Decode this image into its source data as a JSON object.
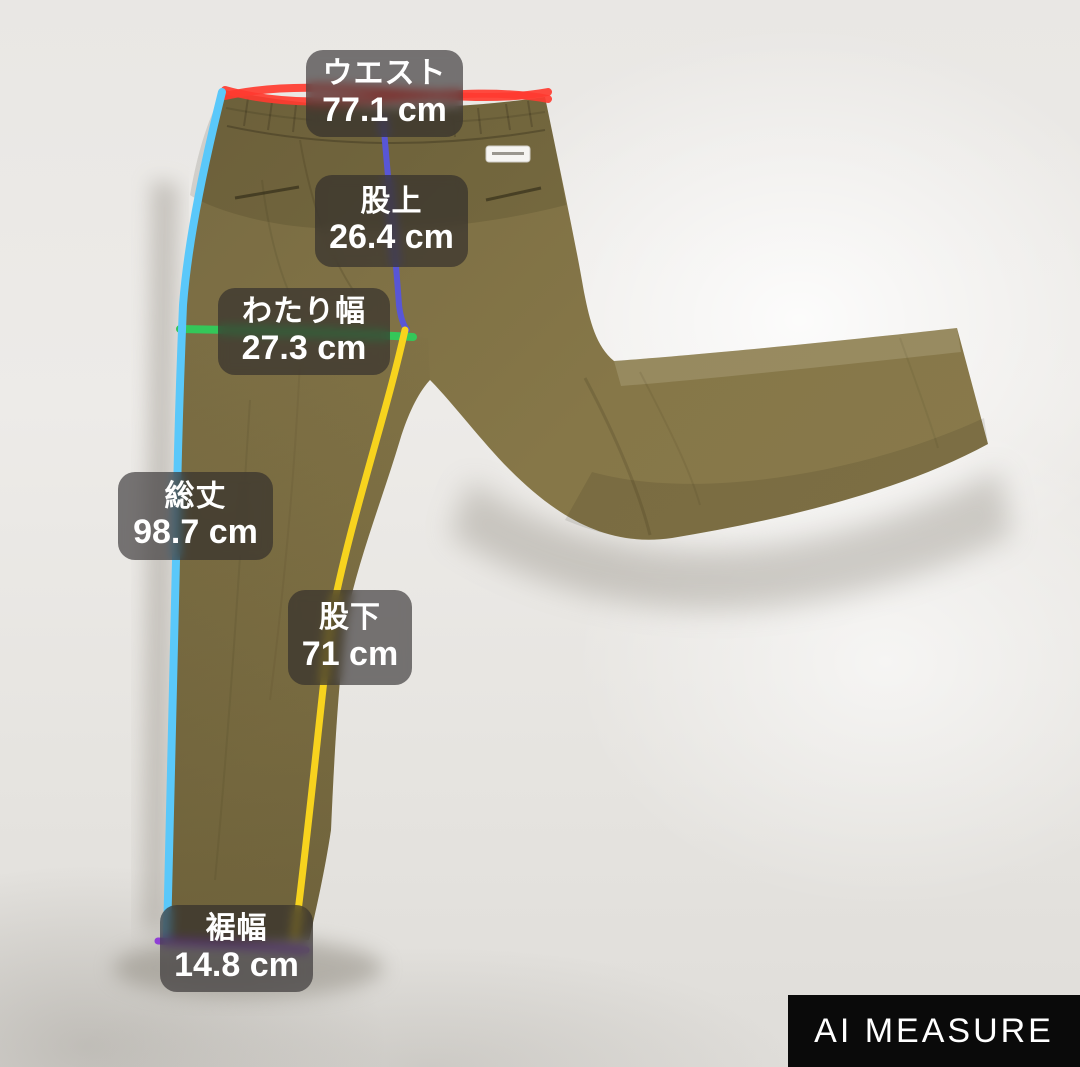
{
  "scene": {
    "background_color": "#e9e7e4",
    "pants_color": "#847547"
  },
  "watermark": {
    "label": "AI MEASURE",
    "bg_color": "#0a0a0a",
    "text_color": "#ffffff"
  },
  "measurements": [
    {
      "id": "waist",
      "name": "ウエスト",
      "value": "77.1 cm",
      "line_color": "#ff3b30"
    },
    {
      "id": "rise",
      "name": "股上",
      "value": "26.4 cm",
      "line_color": "#5856d6"
    },
    {
      "id": "thigh",
      "name": "わたり幅",
      "value": "27.3 cm",
      "line_color": "#34c759"
    },
    {
      "id": "total",
      "name": "総丈",
      "value": "98.7 cm",
      "line_color": "#5ac8fa"
    },
    {
      "id": "inseam",
      "name": "股下",
      "value": "71 cm",
      "line_color": "#f7d31e"
    },
    {
      "id": "hem",
      "name": "裾幅",
      "value": "14.8 cm",
      "line_color": "#8f3fd4"
    }
  ]
}
